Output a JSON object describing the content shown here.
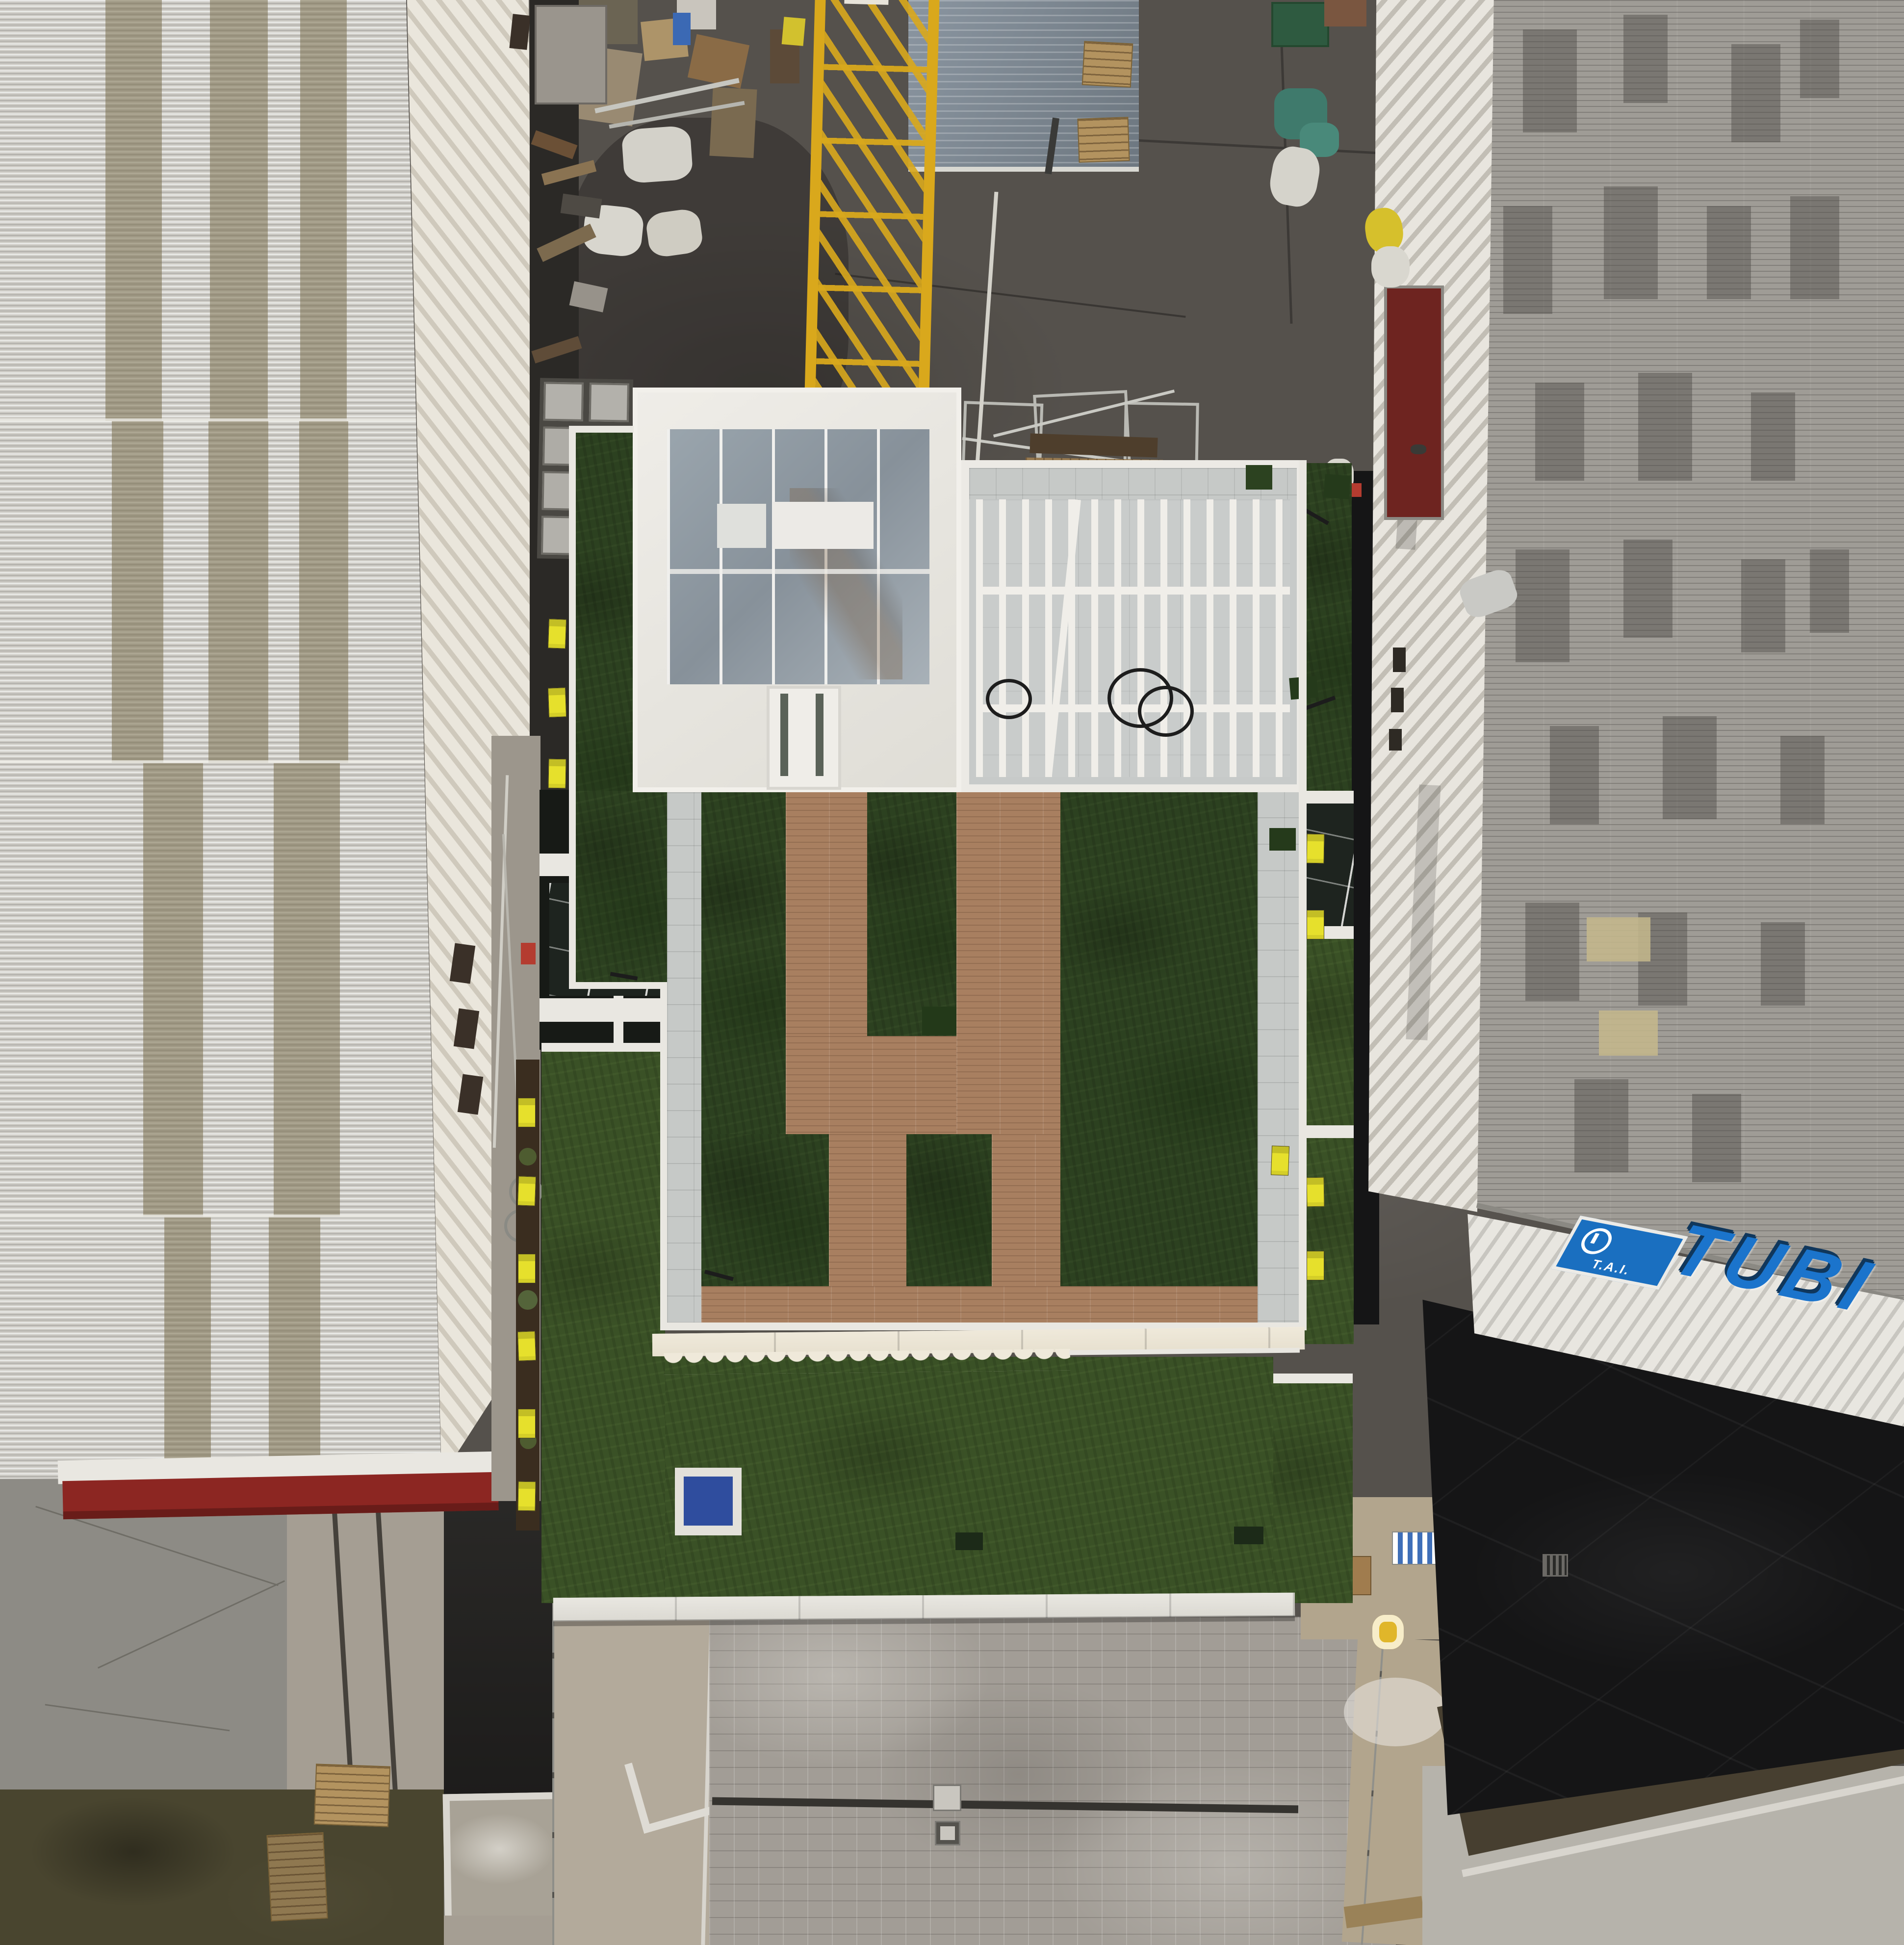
{
  "scene": {
    "title": "Top-down aerial drone photo of a new rooftop garden terrace between two industrial warehouses",
    "view": "orthographic top-down drone shot",
    "signage": {
      "roof_sign_text": "TUBI",
      "roof_sign_logo_text": "T.A.I."
    },
    "palette": {
      "yard_asphalt": "#55514c",
      "deep_black_asphalt": "#151516",
      "left_roof_base": "#cdcbc5",
      "left_roof_tan_stripe": "#7a6f4e",
      "left_roof_cream_slope": "#dfdacd",
      "right_roof_speckled": "#9f9c96",
      "right_roof_white_band": "#e8e5de",
      "terrace_grass_dark": "#2c4120",
      "terrace_grass_light": "#3a5126",
      "deck_wood_brown": "#a87f60",
      "walkway_tiles_gray": "#c6c9c7",
      "cobblestone_plaza": "#a29d96",
      "crane_yellow": "#d9a81c",
      "shed_roof_blue_gray": "#7b8692",
      "awning_cream": "#efe9da",
      "red_eave_strip": "#8c2622",
      "loading_door_red": "#6e2420",
      "sign_blue": "#1b74cc",
      "warning_tag_yellow": "#e6e02c",
      "tarp_blue": "#2f4d9e",
      "dumpster_green": "#2e5a40"
    },
    "objects": {
      "left_building": "warehouse with corrugated roof and tan stripes, red eave strip at south end",
      "right_building": "warehouse with speckled gray corrugated roof, white ribbed edge band, red loading door, blue TUBI roof sign",
      "center_building": "new residential building with rooftop terrace: glass skylight box, white pergola, artificial grass, H-shaped wood composite deck, scalloped awning, lower grass terraces",
      "construction_yard": "asphalt yard with yellow tower crane, gray shed, pallets, cardboard debris, scaffolding, green dumpster",
      "plaza": "gray cobblestone paving with linear drainage channel and manholes",
      "details": "yellow warning tags along glass balustrades, coiled black cables on pergola floor, blue tarp in white planter box"
    }
  }
}
